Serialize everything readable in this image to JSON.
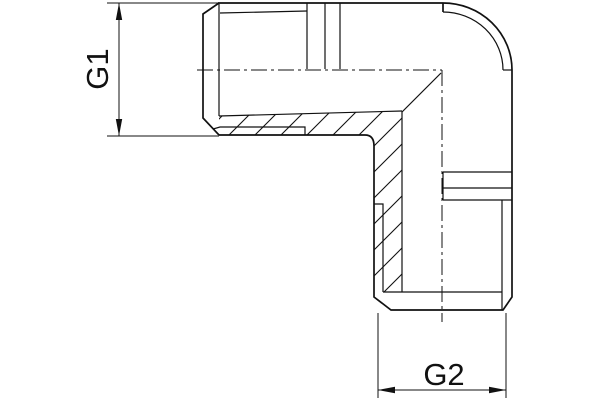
{
  "drawing": {
    "labels": {
      "g1": "G1",
      "g2": "G2"
    },
    "colors": {
      "line": "#111111",
      "background": "#ffffff"
    }
  }
}
